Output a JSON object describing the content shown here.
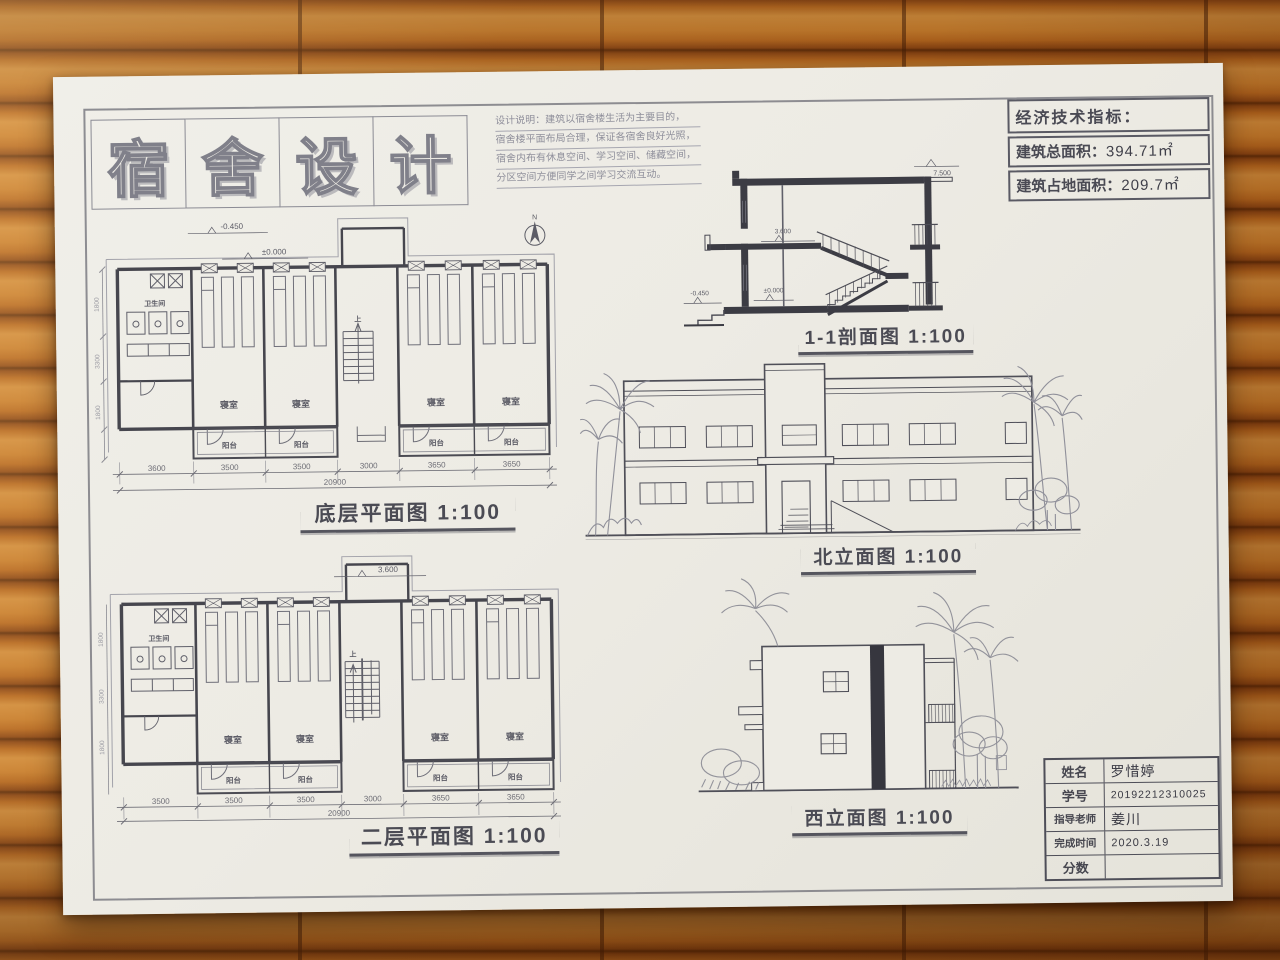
{
  "poster_title": {
    "chars": [
      "宿",
      "舍",
      "设",
      "计"
    ]
  },
  "design_notes": {
    "lines": [
      "设计说明：建筑以宿舍楼生活为主要目的，",
      "宿舍楼平面布局合理，保证各宿舍良好光照，",
      "宿舍内布有休息空间、学习空间、储藏空间，",
      "分区空间方便同学之间学习交流互动。"
    ]
  },
  "indicators": {
    "title": "经济技术指标：",
    "rows": [
      {
        "label": "建筑总面积：",
        "value": "394.71㎡"
      },
      {
        "label": "建筑占地面积：",
        "value": "209.7㎡"
      }
    ]
  },
  "drawing_labels": {
    "ground_plan": "底层平面图 1:100",
    "second_plan": "二层平面图 1:100",
    "section": "1-1剖面图 1:100",
    "north_elevation": "北立面图 1:100",
    "west_elevation": "西立面图 1:100"
  },
  "plan_terms": {
    "bedroom": "寝室",
    "balcony": "阳台",
    "bathroom": "卫生间",
    "up": "上",
    "north": "N"
  },
  "levels": {
    "minus0450": "-0.450",
    "zero": "±0.000",
    "l3600": "3.600",
    "l7500": "7.500"
  },
  "dims": {
    "ground": [
      "3600",
      "3500",
      "3500",
      "3000",
      "3650",
      "3650"
    ],
    "second": [
      "3500",
      "3500",
      "3500",
      "3000",
      "3650",
      "3650"
    ],
    "total": "20900",
    "left": [
      "1800",
      "3300",
      "1800"
    ]
  },
  "name_table": {
    "rows": [
      {
        "label": "姓名",
        "value": "罗惜婷"
      },
      {
        "label": "学号",
        "value": "20192212310025"
      },
      {
        "label": "指导老师",
        "value": "姜川"
      },
      {
        "label": "完成时间",
        "value": "2020.3.19"
      },
      {
        "label": "分数",
        "value": ""
      }
    ]
  }
}
